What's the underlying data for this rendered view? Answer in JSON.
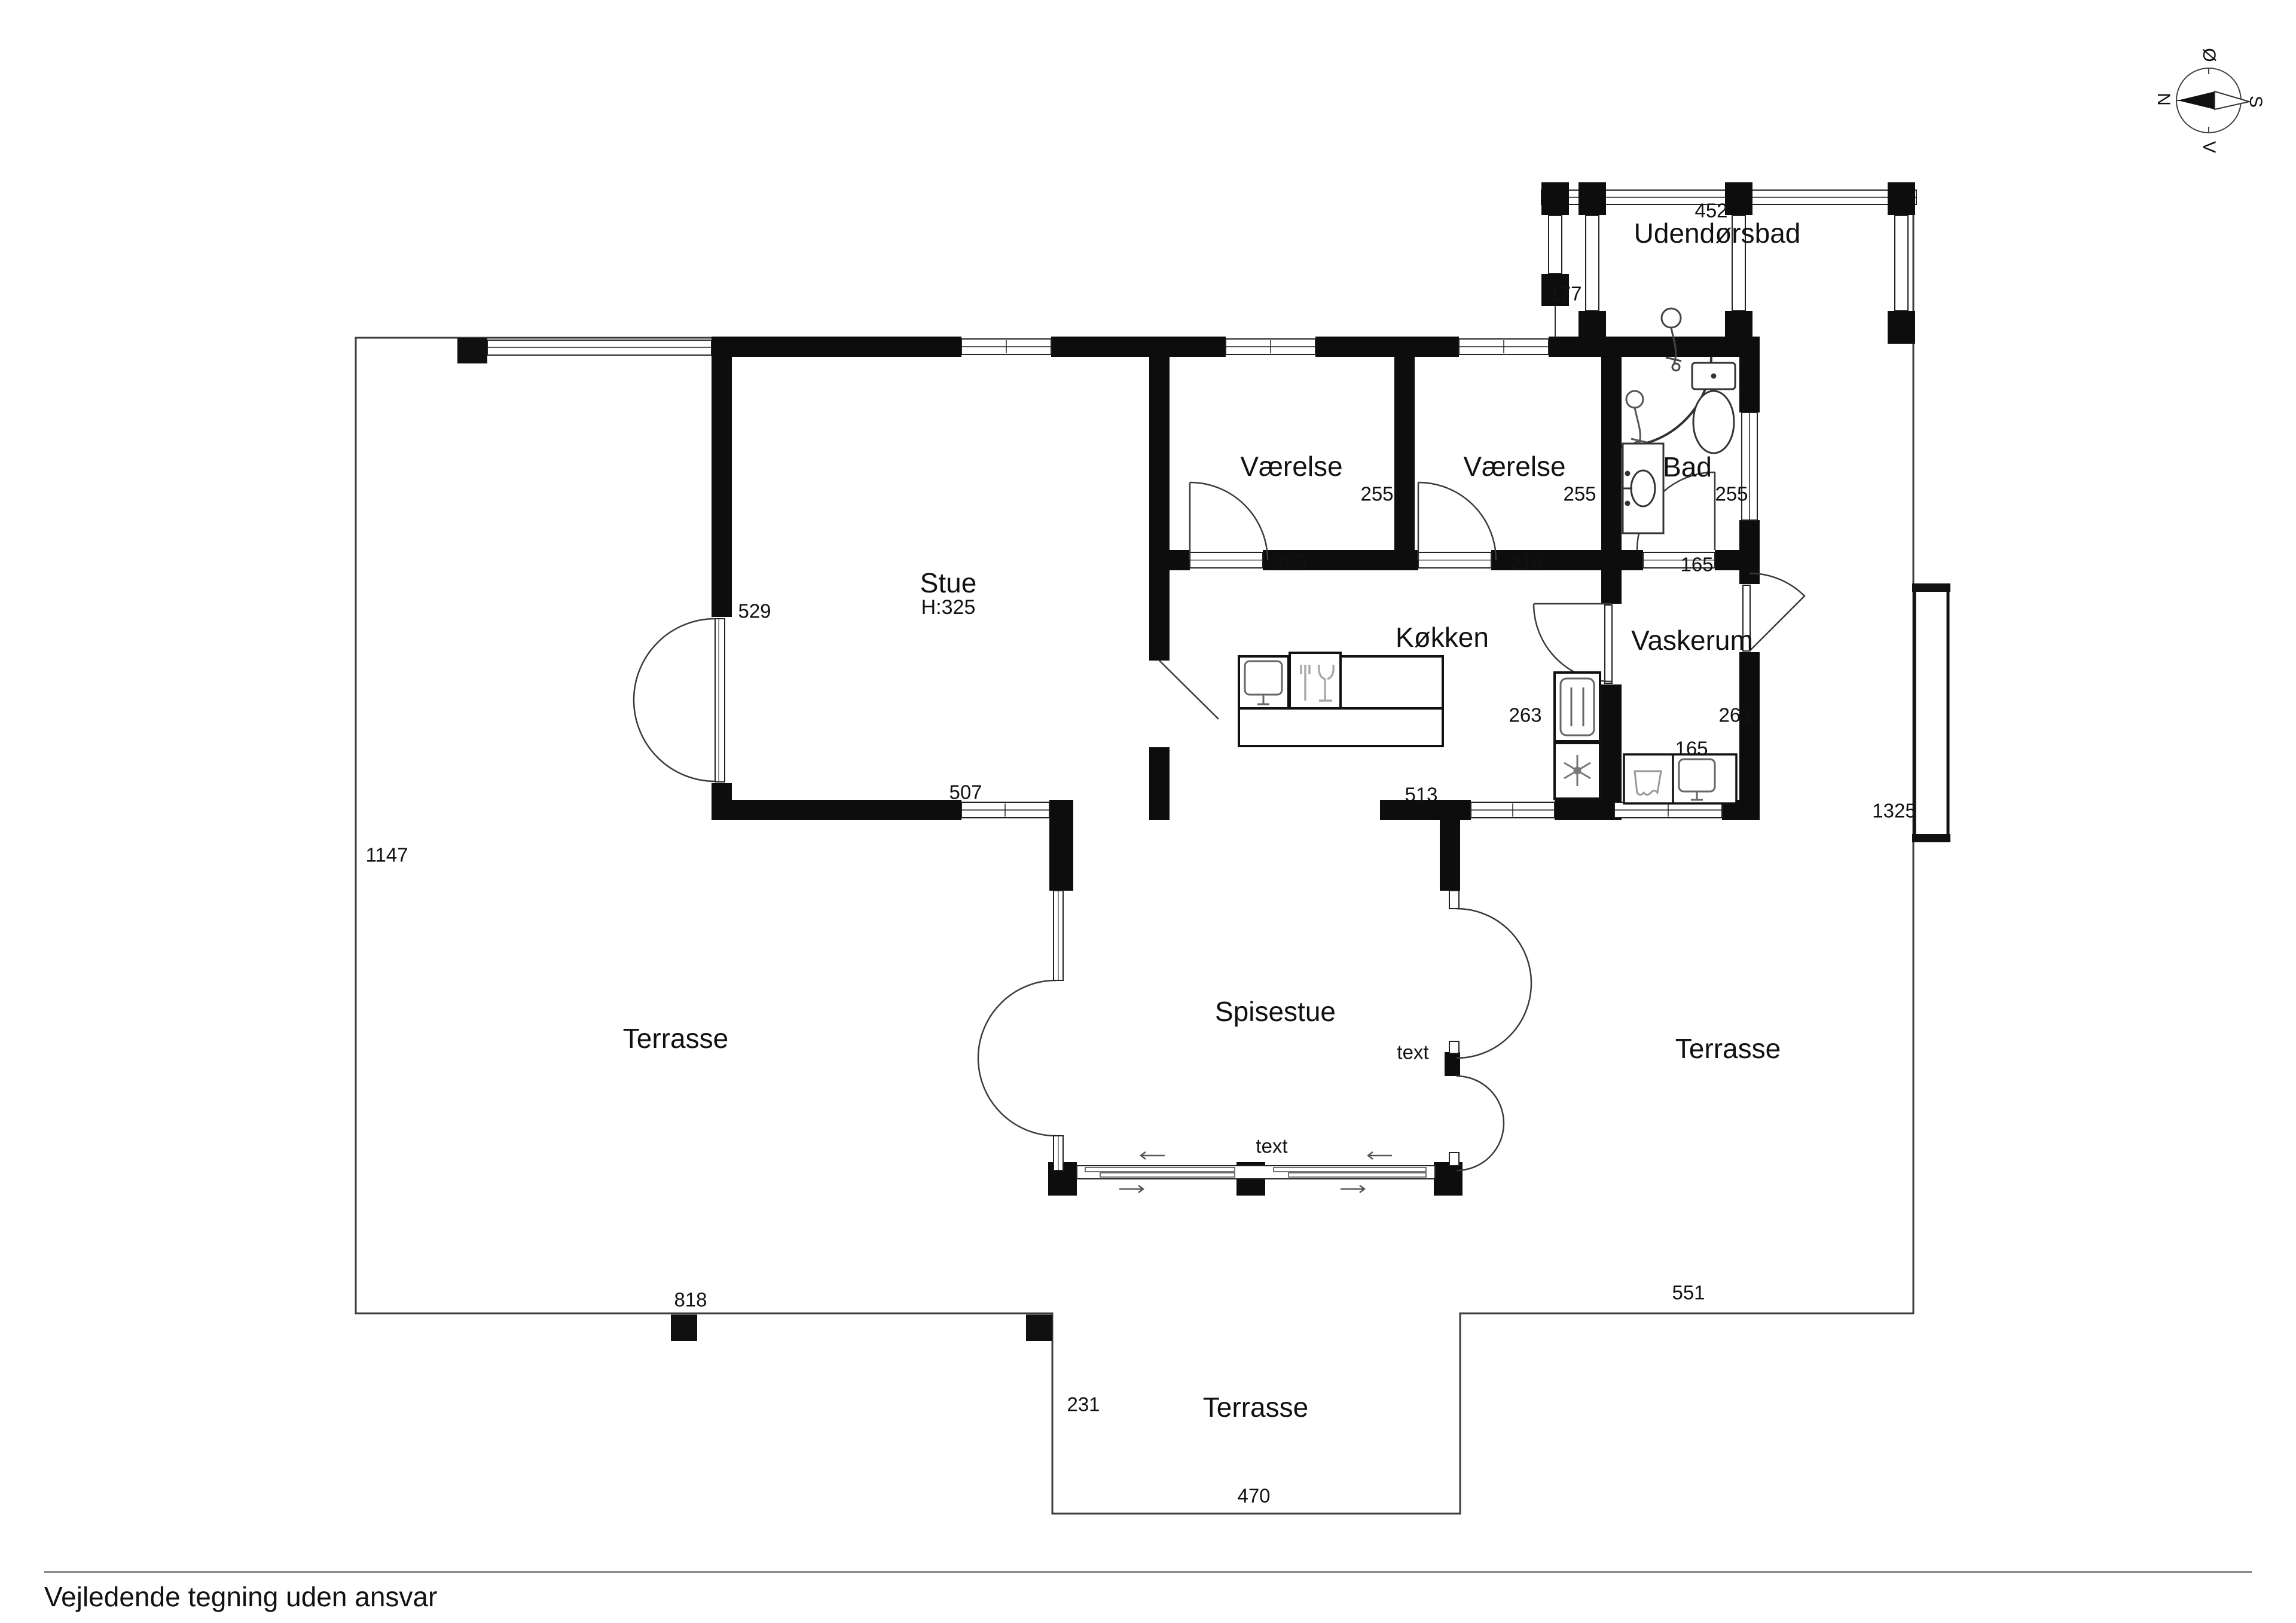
{
  "compass": {
    "north": "N",
    "east": "Ø",
    "south": "S",
    "west": "V"
  },
  "rooms": {
    "stue": {
      "name": "Stue",
      "ceiling_height": "H:325"
    },
    "vaerelse_1": {
      "name": "Værelse",
      "depth": "255",
      "door_width": "285"
    },
    "vaerelse_2": {
      "name": "Værelse",
      "depth": "255",
      "door_width": "216"
    },
    "bad": {
      "name": "Bad",
      "depth": "255",
      "door_width": "165"
    },
    "koekken": {
      "name": "Køkken",
      "depth": "263"
    },
    "vaskerum": {
      "name": "Vaskerum",
      "depth": "263",
      "width": "165"
    },
    "spisestue": {
      "name": "Spisestue",
      "label_east": "text",
      "label_south": "text"
    },
    "udendoersbad": {
      "name": "Udendørsbad",
      "width": "452",
      "depth": "177"
    },
    "terrasse_vest": {
      "name": "Terrasse"
    },
    "terrasse_oest": {
      "name": "Terrasse"
    },
    "terrasse_syd": {
      "name": "Terrasse"
    }
  },
  "dimensions": {
    "stue_door": "529",
    "stue_wall": "507",
    "passage": "513",
    "west_side": "1147",
    "south_west": "818",
    "south_east": "551",
    "notch_depth": "231",
    "notch_width": "470",
    "east_gate": "1325"
  },
  "footer": {
    "disclaimer": "Vejledende tegning uden ansvar"
  }
}
